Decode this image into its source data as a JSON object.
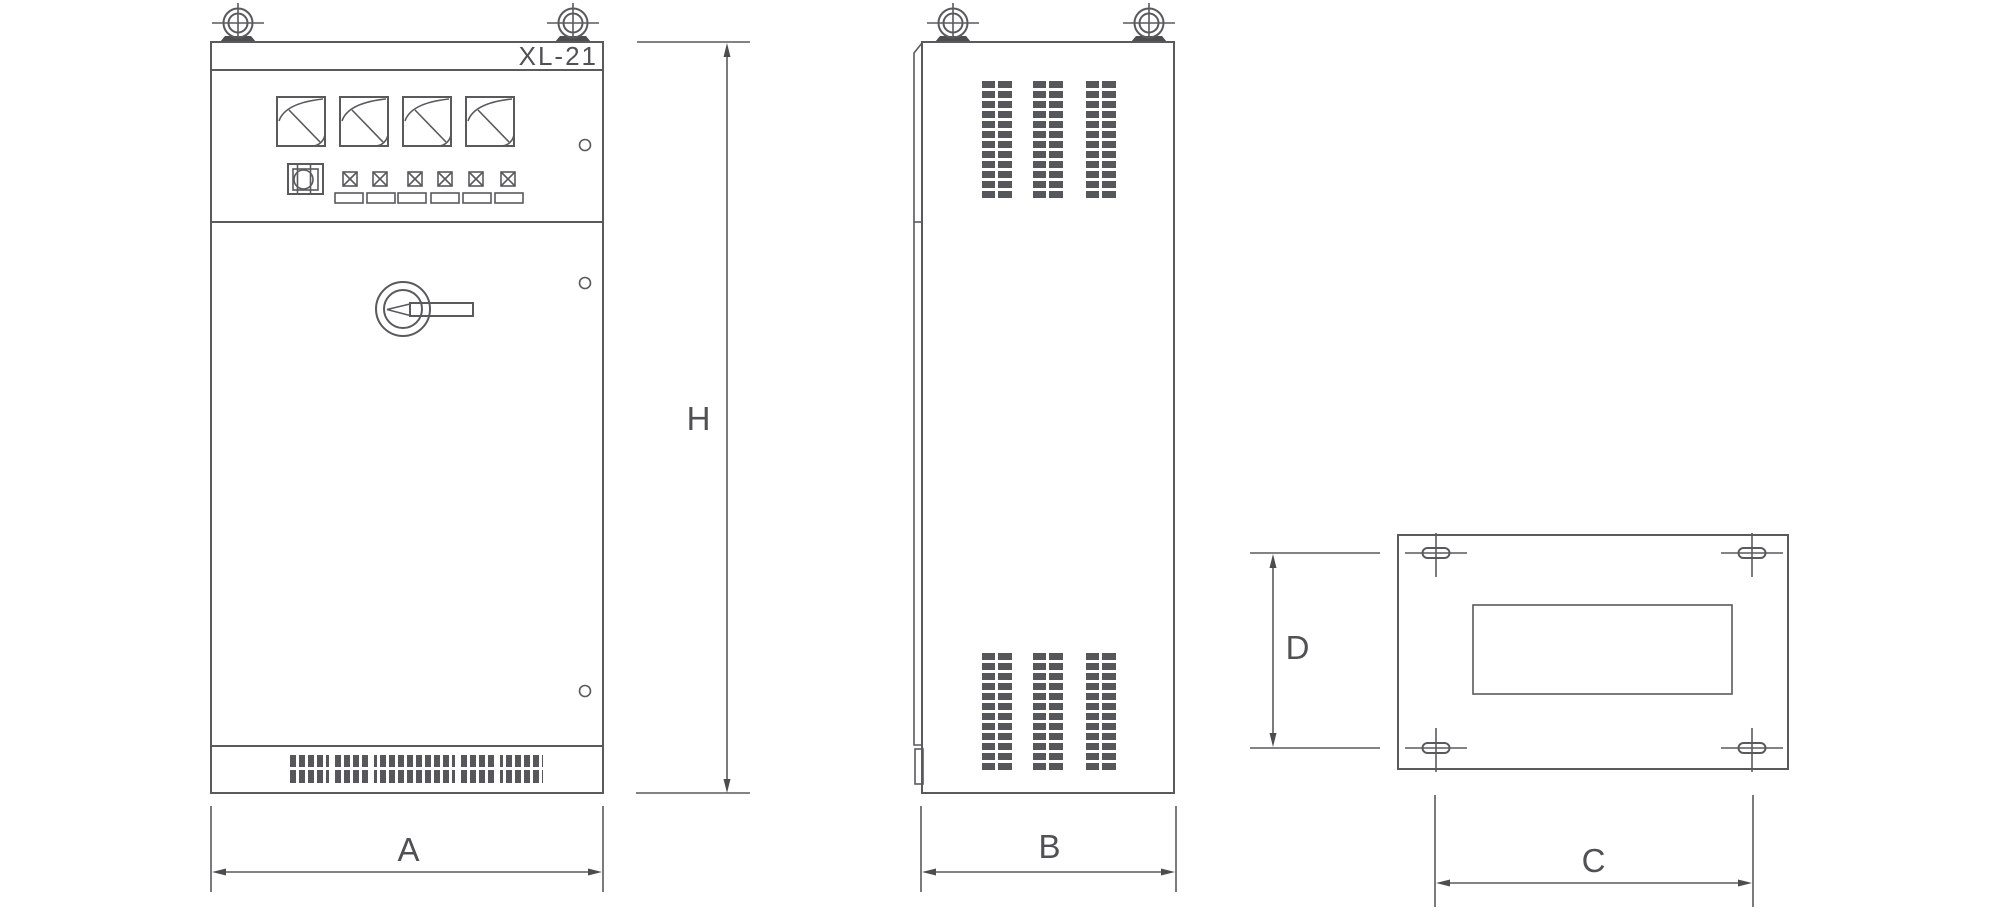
{
  "labels": {
    "model": "XL-21",
    "dim_height": "H",
    "dim_width": "A",
    "dim_depth": "B",
    "dim_mount_width": "C",
    "dim_mount_depth": "D"
  },
  "colors": {
    "line": "#595a5c",
    "vent": "#56575a",
    "pad_fill": "#4c4d4f",
    "text": "#505154",
    "background": "#ffffff"
  }
}
